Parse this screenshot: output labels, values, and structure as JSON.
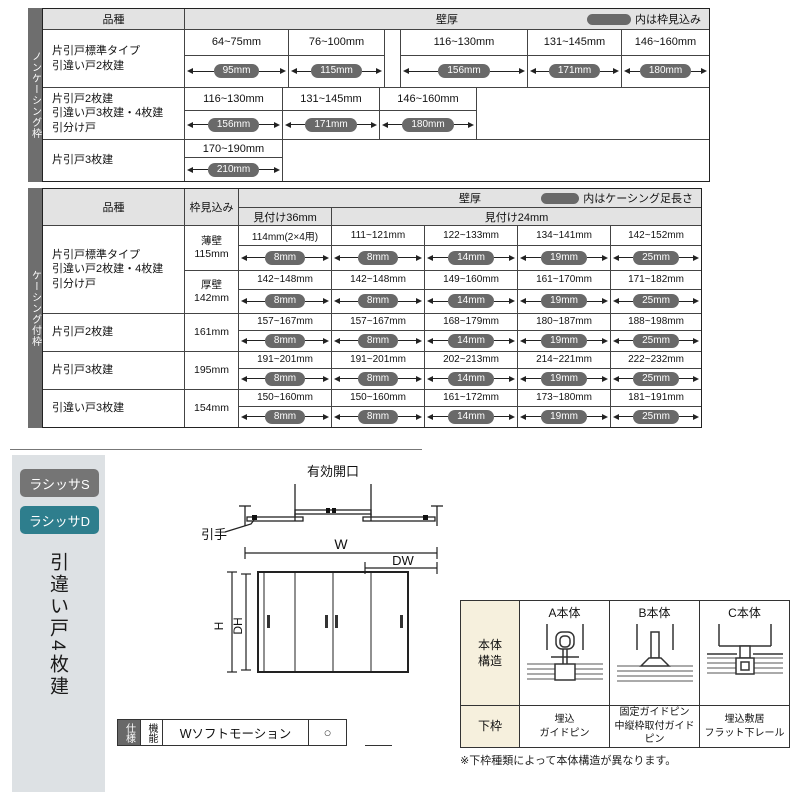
{
  "colors": {
    "pill_gray": "#696969",
    "strip_gray": "#6e6e6e",
    "header_gray": "#e3e3e3",
    "teal": "#2e7e8d",
    "badge_gray": "#757575",
    "panel_gray": "#dde1e4",
    "beige": "#f6f0dd"
  },
  "t1": {
    "side": "ノンケーシング枠",
    "kind": "品種",
    "wall": "壁厚",
    "note": "内は枠見込み",
    "rows": [
      {
        "label": "片引戸標準タイプ\n引違い戸2枚建",
        "cells": [
          {
            "range": "64~75mm",
            "depth": "95mm"
          },
          {
            "range": "76~100mm",
            "depth": "115mm"
          },
          {
            "range": "116~130mm",
            "depth": "156mm"
          },
          {
            "range": "131~145mm",
            "depth": "171mm"
          },
          {
            "range": "146~160mm",
            "depth": "180mm"
          }
        ]
      },
      {
        "label": "片引戸2枚建\n引違い戸3枚建・4枚建\n引分け戸",
        "cells": [
          {
            "range": "116~130mm",
            "depth": "156mm"
          },
          {
            "range": "131~145mm",
            "depth": "171mm"
          },
          {
            "range": "146~160mm",
            "depth": "180mm"
          }
        ]
      },
      {
        "label": "片引戸3枚建",
        "cells": [
          {
            "range": "170~190mm",
            "depth": "210mm"
          }
        ]
      }
    ]
  },
  "t2": {
    "side": "ケーシング付枠",
    "kind": "品種",
    "jamb_h": "枠見込み",
    "wall": "壁厚",
    "note": "内はケーシング足長さ",
    "sub36": "見付け36mm",
    "sub24": "見付け24mm",
    "g1": "片引戸標準タイプ\n引違い戸2枚建・4枚建\n引分け戸",
    "rows": [
      {
        "jamb": "薄壁\n115mm",
        "cells": [
          {
            "range": "114mm(2×4用)",
            "depth": "8mm"
          },
          {
            "range": "111~121mm",
            "depth": "8mm"
          },
          {
            "range": "122~133mm",
            "depth": "14mm"
          },
          {
            "range": "134~141mm",
            "depth": "19mm"
          },
          {
            "range": "142~152mm",
            "depth": "25mm"
          }
        ]
      },
      {
        "jamb": "厚壁\n142mm",
        "cells": [
          {
            "range": "142~148mm",
            "depth": "8mm"
          },
          {
            "range": "142~148mm",
            "depth": "8mm"
          },
          {
            "range": "149~160mm",
            "depth": "14mm"
          },
          {
            "range": "161~170mm",
            "depth": "19mm"
          },
          {
            "range": "171~182mm",
            "depth": "25mm"
          }
        ]
      },
      {
        "label": "片引戸2枚建",
        "jamb": "161mm",
        "cells": [
          {
            "range": "157~167mm",
            "depth": "8mm"
          },
          {
            "range": "157~167mm",
            "depth": "8mm"
          },
          {
            "range": "168~179mm",
            "depth": "14mm"
          },
          {
            "range": "180~187mm",
            "depth": "19mm"
          },
          {
            "range": "188~198mm",
            "depth": "25mm"
          }
        ]
      },
      {
        "label": "片引戸3枚建",
        "jamb": "195mm",
        "cells": [
          {
            "range": "191~201mm",
            "depth": "8mm"
          },
          {
            "range": "191~201mm",
            "depth": "8mm"
          },
          {
            "range": "202~213mm",
            "depth": "14mm"
          },
          {
            "range": "214~221mm",
            "depth": "19mm"
          },
          {
            "range": "222~232mm",
            "depth": "25mm"
          }
        ]
      },
      {
        "label": "引違い戸3枚建",
        "jamb": "154mm",
        "cells": [
          {
            "range": "150~160mm",
            "depth": "8mm"
          },
          {
            "range": "150~160mm",
            "depth": "8mm"
          },
          {
            "range": "161~172mm",
            "depth": "14mm"
          },
          {
            "range": "173~180mm",
            "depth": "19mm"
          },
          {
            "range": "181~191mm",
            "depth": "25mm"
          }
        ]
      }
    ]
  },
  "sidebar": {
    "badge_s": "ラシッサS",
    "badge_d": "ラシッサD",
    "title": "引違い戸4枚建"
  },
  "diagram": {
    "eo": "有効開口",
    "handle": "引手",
    "w": "W",
    "dw": "DW",
    "h": "H",
    "dh": "DH"
  },
  "spec": {
    "header": "仕様",
    "func": "機能",
    "name": "Wソフトモーション",
    "val": "○"
  },
  "bt": {
    "r1h": "本体\n構造",
    "r2h": "下枠",
    "cols": [
      {
        "name": "A本体",
        "frame": "埋込\nガイドピン"
      },
      {
        "name": "B本体",
        "frame": "固定ガイドピン\n中縦枠取付ガイドピン"
      },
      {
        "name": "C本体",
        "frame": "埋込敷居\nフラット下レール"
      }
    ],
    "note": "※下枠種類によって本体構造が異なります。"
  }
}
